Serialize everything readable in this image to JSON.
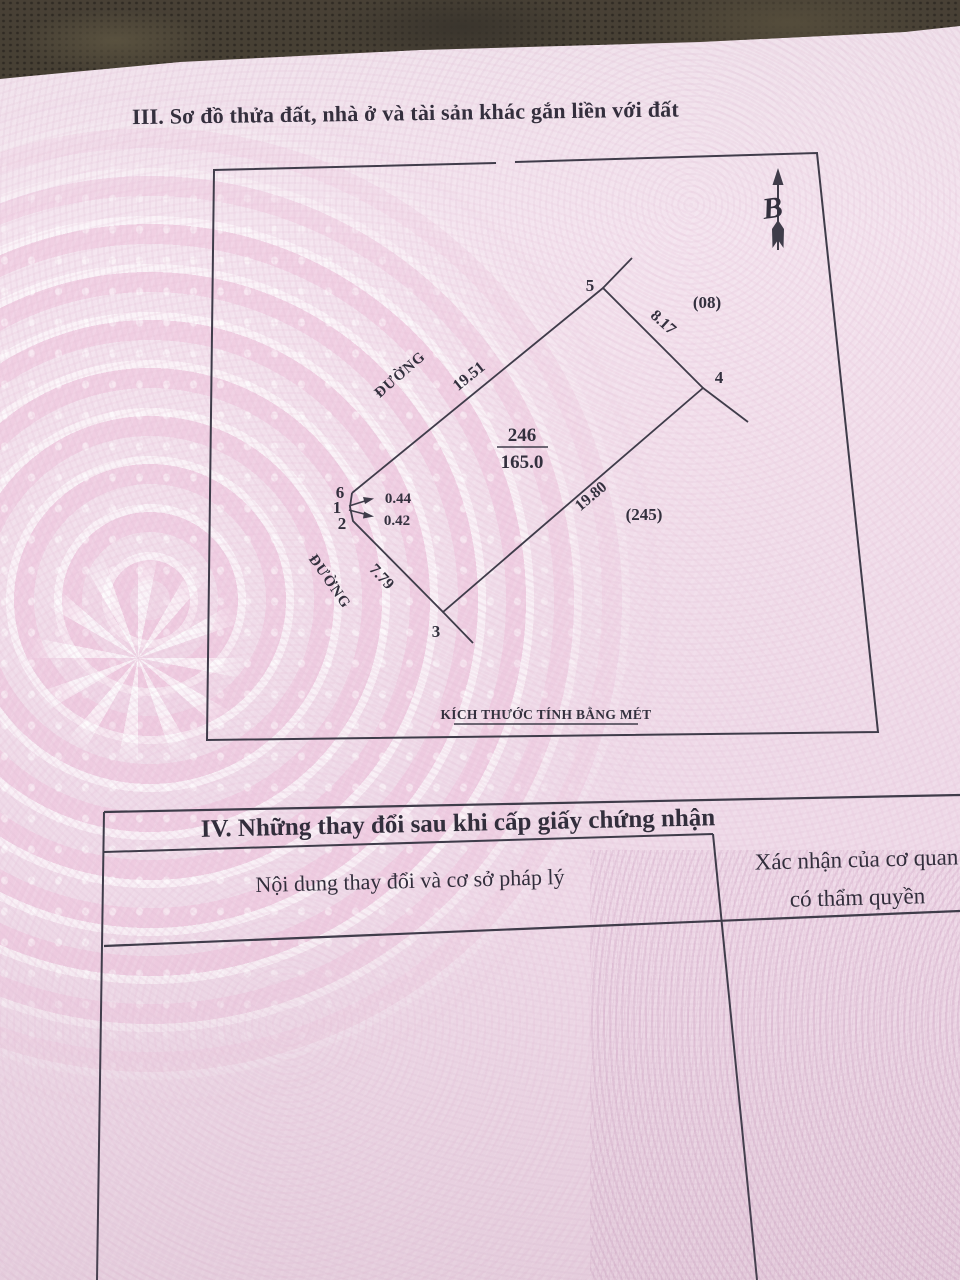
{
  "section3": {
    "title": "III. Sơ đồ thửa đất, nhà ở và tài sản khác gắn liền với đất"
  },
  "diagram": {
    "north_label": "B",
    "parcel_number": "246",
    "parcel_area": "165.0",
    "road_label_upper": "ĐƯỜNG",
    "road_label_lower": "ĐƯỜNG",
    "adjacent_plot_top_right": "(08)",
    "adjacent_plot_bottom_right": "(245)",
    "vertex_labels": {
      "v1": "1",
      "v2": "2",
      "v3": "3",
      "v4": "4",
      "v5": "5",
      "v6": "6"
    },
    "edge_lengths": {
      "e6_5": "19.51",
      "e5_4": "8.17",
      "e4_3": "19.80",
      "e3_2": "7.79",
      "e1_6": "0.44",
      "e2_1": "0.42"
    },
    "caption": "KÍCH THƯỚC TÍNH BẰNG MÉT"
  },
  "section4": {
    "title": "IV. Những thay đổi sau khi cấp giấy chứng nhận",
    "left_column_header": "Nội dung thay đổi và cơ sở pháp lý",
    "right_column_header_line1": "Xác nhận của cơ quan",
    "right_column_header_line2": "có thẩm quyền"
  },
  "colors": {
    "paper_pink": "#f3e1ec",
    "pattern_pink": "#eec6db",
    "ink": "#37343f",
    "surface_dark": "#453f32"
  }
}
